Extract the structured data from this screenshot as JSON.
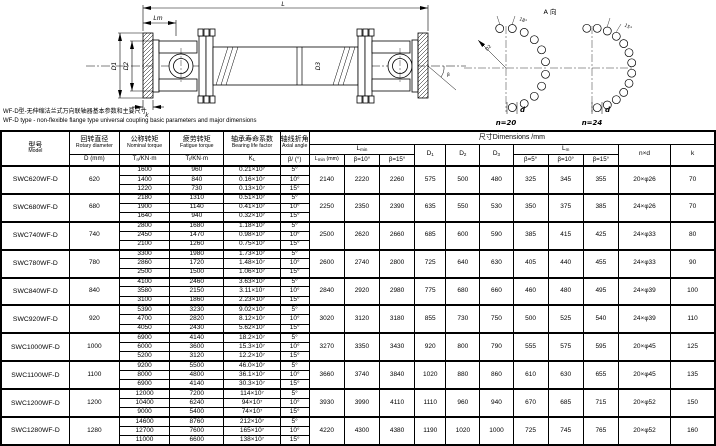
{
  "captions": {
    "cn": "WF-D型-无伸缩法兰式万向联轴器基本参数和主要尺寸",
    "en": "WF-D type - non-flexible flange type universal coupling basic parameters and major dimensions"
  },
  "drawing": {
    "dim_L": "L",
    "dim_Lm": "Lm",
    "dim_D1": "D1",
    "dim_D2": "D2",
    "dim_D3": "D3",
    "dim_k": "k",
    "beta": "β",
    "view_label": "A 向",
    "bc_ref": "D2",
    "angle20": "18°",
    "angle24": "15°",
    "hole_d20": "d",
    "hole_d24": "d",
    "n20": "n=20",
    "n24": "n=24"
  },
  "table": {
    "title_dims": "尺寸Dimensions /mm",
    "col_model": {
      "cn": "型号",
      "en": "Model"
    },
    "col_rotary": {
      "cn": "回转直径",
      "en": "Rotary diameter",
      "sym_base": "D",
      "sym_sub": "",
      "sym_rest": " (mm)"
    },
    "col_nominal": {
      "cn": "公称转矩",
      "en": "Nominal torque",
      "sym_base": "T",
      "sym_sub": "n",
      "sym_rest": "/KN·m"
    },
    "col_fatigue": {
      "cn": "疲劳转矩",
      "en": "Fatigue torque",
      "sym_base": "T",
      "sym_sub": "f",
      "sym_rest": "/KN·m"
    },
    "col_bearing": {
      "cn": "轴承寿命系数",
      "en": "Bearing life factor",
      "sym_base": "K",
      "sym_sub": "L",
      "sym_rest": ""
    },
    "col_angle": {
      "cn": "轴线折角",
      "en": "Axial angle",
      "sym": "β/ (°)"
    },
    "col_lmin": {
      "base": "L",
      "sub": "min",
      "s1_base": "L",
      "s1_sub": "min",
      "s1_rest": " (mm)",
      "s2": "β=10°",
      "s3": "β=15°"
    },
    "col_d1": {
      "base": "D",
      "sub": "1"
    },
    "col_d2": {
      "base": "D",
      "sub": "2"
    },
    "col_d3": {
      "base": "D",
      "sub": "3"
    },
    "col_lm": {
      "base": "L",
      "sub": "m",
      "s1": "β=5°",
      "s2": "β=10°",
      "s3": "β=15°"
    },
    "col_nxd": "n×d",
    "col_k": "k",
    "rows": [
      {
        "model": "SWC620WF-D",
        "d": "620",
        "sub": [
          [
            "1600",
            "960",
            "0.21×10⁷",
            "5°"
          ],
          [
            "1400",
            "840",
            "0.16×10⁷",
            "10°"
          ],
          [
            "1220",
            "730",
            "0.13×10⁷",
            "15°"
          ]
        ],
        "lmin": "2140",
        "lmin10": "2220",
        "lmin15": "2260",
        "d1": "575",
        "d2": "500",
        "d3": "480",
        "lm5": "325",
        "lm10": "345",
        "lm15": "355",
        "nxd": "20×φ26",
        "k": "70"
      },
      {
        "model": "SWC680WF-D",
        "d": "680",
        "sub": [
          [
            "2180",
            "1310",
            "0.51×10⁷",
            "5°"
          ],
          [
            "1900",
            "1140",
            "0.41×10⁷",
            "10°"
          ],
          [
            "1640",
            "940",
            "0.32×10⁷",
            "15°"
          ]
        ],
        "lmin": "2250",
        "lmin10": "2350",
        "lmin15": "2390",
        "d1": "635",
        "d2": "550",
        "d3": "530",
        "lm5": "350",
        "lm10": "375",
        "lm15": "385",
        "nxd": "24×φ26",
        "k": "70"
      },
      {
        "model": "SWC740WF-D",
        "d": "740",
        "sub": [
          [
            "2800",
            "1680",
            "1.18×10⁷",
            "5°"
          ],
          [
            "2450",
            "1470",
            "0.98×10⁷",
            "10°"
          ],
          [
            "2100",
            "1260",
            "0.75×10⁷",
            "15°"
          ]
        ],
        "lmin": "2500",
        "lmin10": "2620",
        "lmin15": "2660",
        "d1": "685",
        "d2": "600",
        "d3": "590",
        "lm5": "385",
        "lm10": "415",
        "lm15": "425",
        "nxd": "24×φ33",
        "k": "80"
      },
      {
        "model": "SWC780WF-D",
        "d": "780",
        "sub": [
          [
            "3300",
            "1980",
            "1.73×10⁷",
            "5°"
          ],
          [
            "2860",
            "1720",
            "1.48×10⁷",
            "10°"
          ],
          [
            "2500",
            "1500",
            "1.06×10⁷",
            "15°"
          ]
        ],
        "lmin": "2600",
        "lmin10": "2740",
        "lmin15": "2800",
        "d1": "725",
        "d2": "640",
        "d3": "630",
        "lm5": "405",
        "lm10": "440",
        "lm15": "455",
        "nxd": "24×φ33",
        "k": "90"
      },
      {
        "model": "SWC840WF-D",
        "d": "840",
        "sub": [
          [
            "4100",
            "2460",
            "3.63×10⁷",
            "5°"
          ],
          [
            "3580",
            "2150",
            "3.11×10⁷",
            "10°"
          ],
          [
            "3100",
            "1860",
            "2.23×10⁷",
            "15°"
          ]
        ],
        "lmin": "2840",
        "lmin10": "2920",
        "lmin15": "2980",
        "d1": "775",
        "d2": "680",
        "d3": "660",
        "lm5": "460",
        "lm10": "480",
        "lm15": "495",
        "nxd": "24×φ39",
        "k": "100"
      },
      {
        "model": "SWC920WF-D",
        "d": "920",
        "sub": [
          [
            "5390",
            "3230",
            "9.02×10⁷",
            "5°"
          ],
          [
            "4700",
            "2820",
            "8.12×10⁷",
            "10°"
          ],
          [
            "4050",
            "2430",
            "5.62×10⁷",
            "15°"
          ]
        ],
        "lmin": "3020",
        "lmin10": "3120",
        "lmin15": "3180",
        "d1": "855",
        "d2": "730",
        "d3": "750",
        "lm5": "500",
        "lm10": "525",
        "lm15": "540",
        "nxd": "24×φ39",
        "k": "110"
      },
      {
        "model": "SWC1000WF-D",
        "d": "1000",
        "sub": [
          [
            "6900",
            "4140",
            "18.2×10⁷",
            "5°"
          ],
          [
            "6000",
            "3600",
            "15.3×10⁷",
            "10°"
          ],
          [
            "5200",
            "3120",
            "12.2×10⁷",
            "15°"
          ]
        ],
        "lmin": "3270",
        "lmin10": "3350",
        "lmin15": "3430",
        "d1": "920",
        "d2": "800",
        "d3": "790",
        "lm5": "555",
        "lm10": "575",
        "lm15": "595",
        "nxd": "20×φ45",
        "k": "125"
      },
      {
        "model": "SWC1100WF-D",
        "d": "1100",
        "sub": [
          [
            "9200",
            "5500",
            "46.0×10⁷",
            "5°"
          ],
          [
            "8000",
            "4800",
            "36.1×10⁷",
            "10°"
          ],
          [
            "6900",
            "4140",
            "30.3×10⁷",
            "15°"
          ]
        ],
        "lmin": "3660",
        "lmin10": "3740",
        "lmin15": "3840",
        "d1": "1020",
        "d2": "880",
        "d3": "860",
        "lm5": "610",
        "lm10": "630",
        "lm15": "655",
        "nxd": "20×φ45",
        "k": "135"
      },
      {
        "model": "SWC1200WF-D",
        "d": "1200",
        "sub": [
          [
            "12000",
            "7200",
            "114×10⁷",
            "5°"
          ],
          [
            "10400",
            "6240",
            "94×10⁷",
            "10°"
          ],
          [
            "9000",
            "5400",
            "74×10⁷",
            "15°"
          ]
        ],
        "lmin": "3930",
        "lmin10": "3990",
        "lmin15": "4110",
        "d1": "1110",
        "d2": "960",
        "d3": "940",
        "lm5": "670",
        "lm10": "685",
        "lm15": "715",
        "nxd": "20×φ52",
        "k": "150"
      },
      {
        "model": "SWC1280WF-D",
        "d": "1280",
        "sub": [
          [
            "14600",
            "8760",
            "212×10⁷",
            "5°"
          ],
          [
            "12700",
            "7600",
            "165×10⁷",
            "10°"
          ],
          [
            "11000",
            "6600",
            "138×10⁷",
            "15°"
          ]
        ],
        "lmin": "4220",
        "lmin10": "4300",
        "lmin15": "4380",
        "d1": "1190",
        "d2": "1020",
        "d3": "1000",
        "lm5": "725",
        "lm10": "745",
        "lm15": "765",
        "nxd": "20×φ52",
        "k": "160"
      }
    ]
  }
}
